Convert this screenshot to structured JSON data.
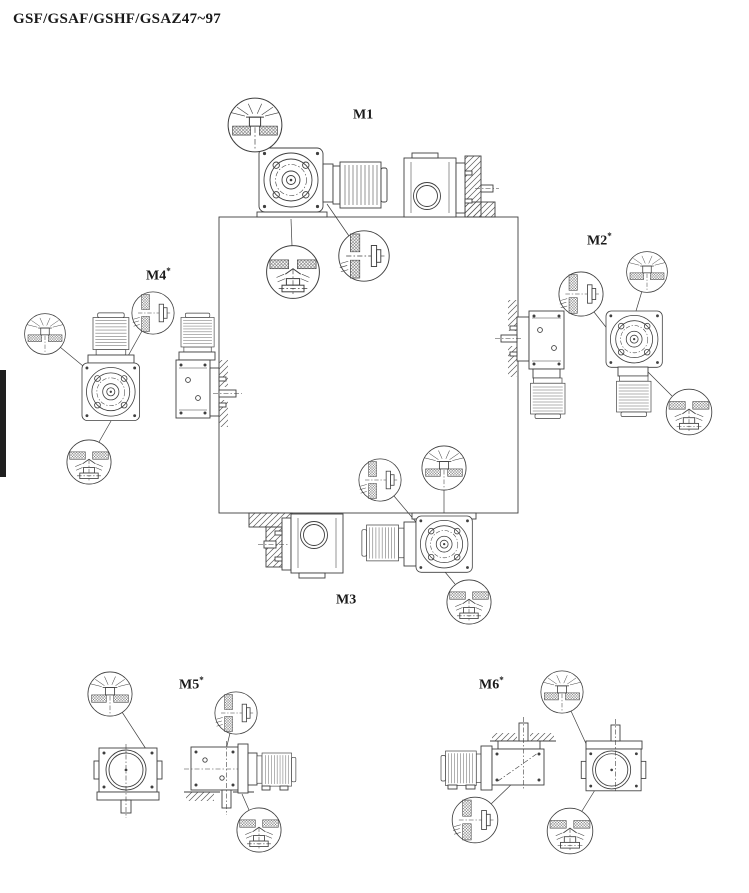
{
  "page": {
    "title": "GSF/GSAF/GSHF/GSAZ47~97"
  },
  "positions": [
    {
      "label": "M1",
      "sup": ""
    },
    {
      "label": "M2",
      "sup": "*"
    },
    {
      "label": "M3",
      "sup": ""
    },
    {
      "label": "M4",
      "sup": "*"
    },
    {
      "label": "M5",
      "sup": "*"
    },
    {
      "label": "M6",
      "sup": "*"
    }
  ],
  "callout_icons": {
    "vent": "breather-vent-plug-icon",
    "level": "oil-level-plug-icon",
    "drain": "oil-drain-plug-icon"
  },
  "colors": {
    "line": "#3f3f3f",
    "background": "#ffffff",
    "text": "#1a1a1a",
    "edge_tab": "#1f1f1f"
  }
}
